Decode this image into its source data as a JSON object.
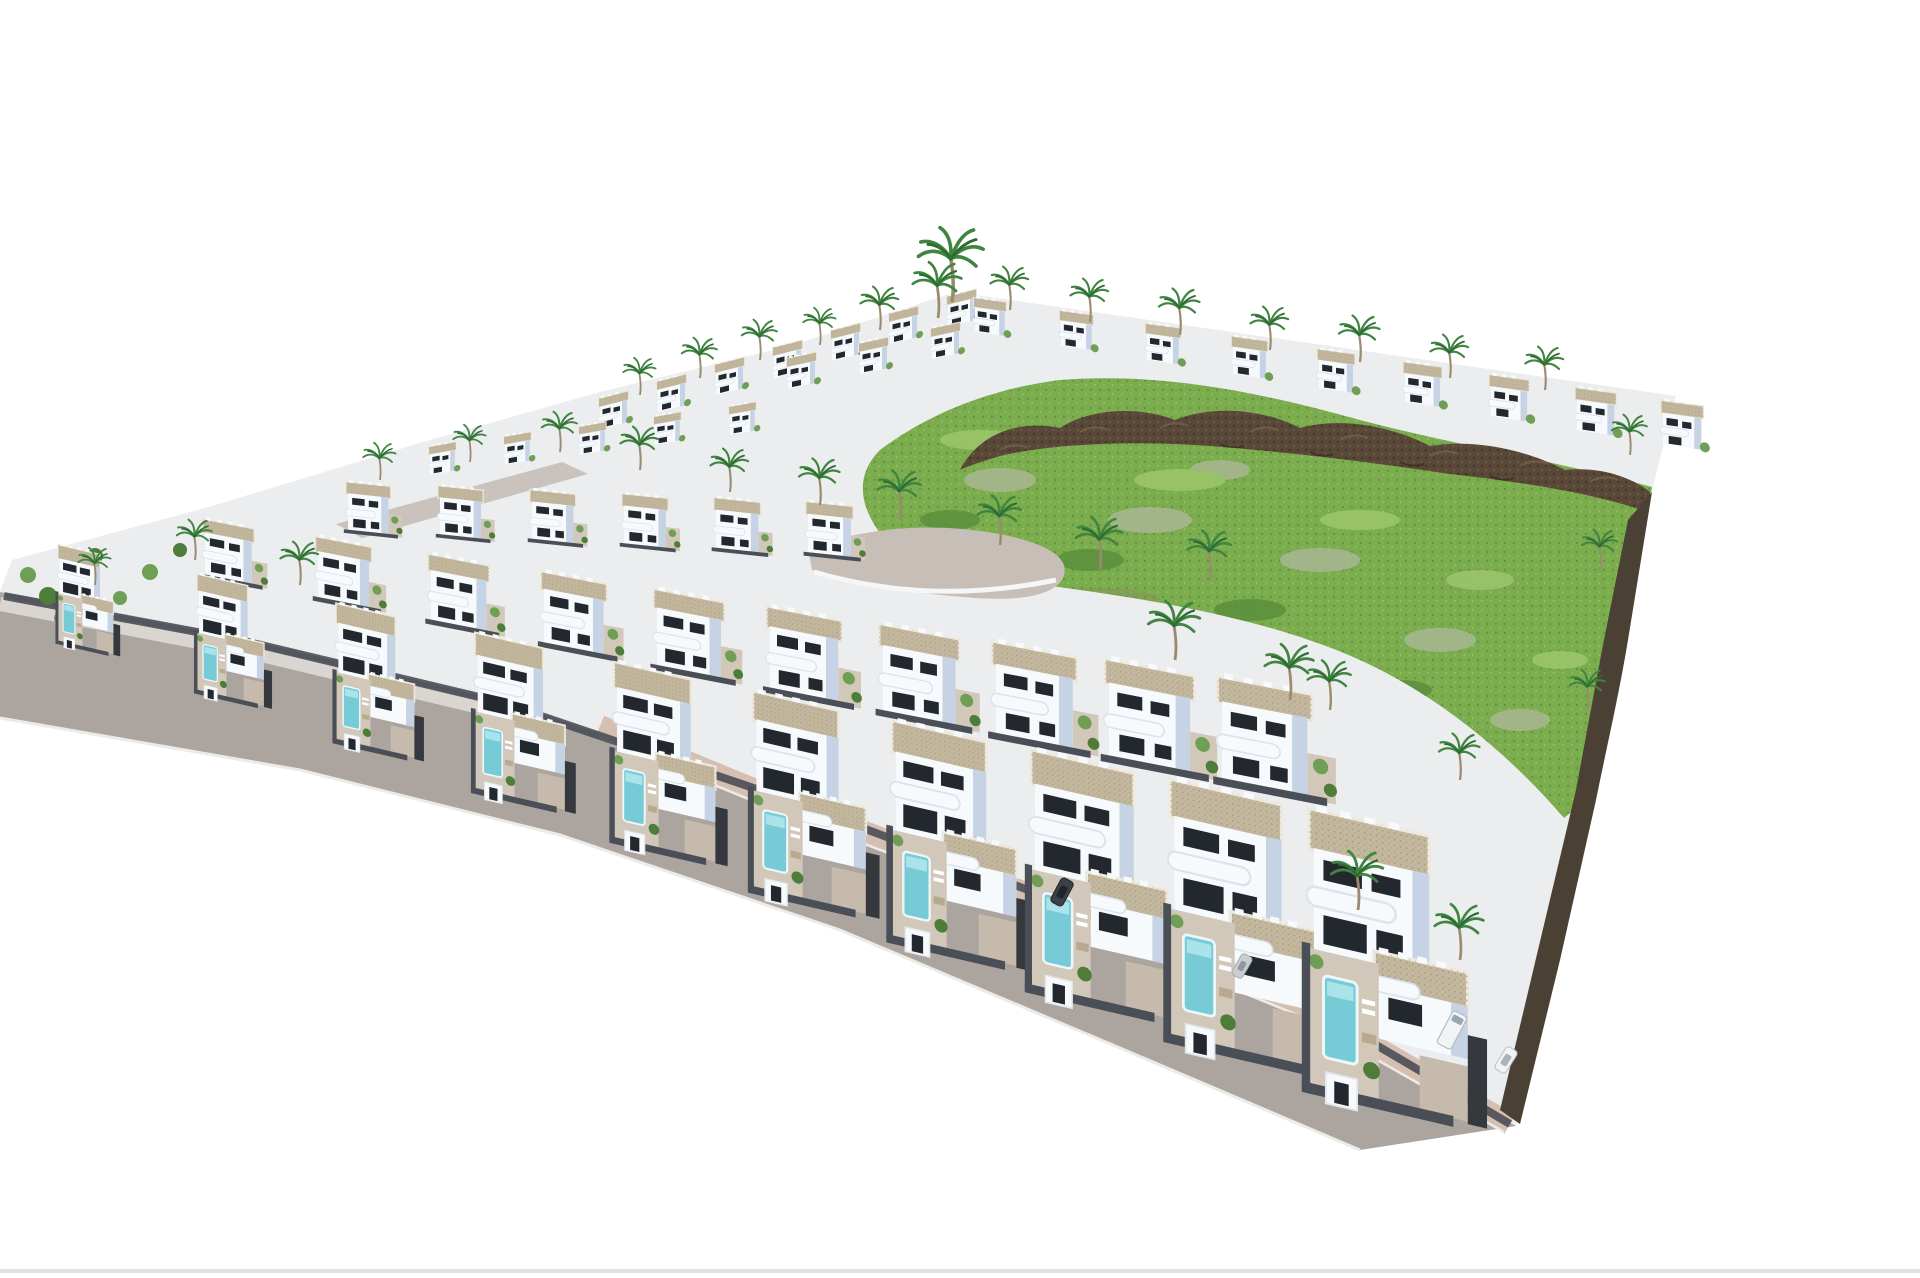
{
  "meta": {
    "description": "3D aerial rendering of a hillside residential development: rows of white modern villas with flat gravel roofs, curved balconies, private pools and palm trees; a green undeveloped hillside with dark volcanic rock outcrops in the centre-right; a grey perimeter road with pink sidewalk and parked cars along the lower-left edge; pure white background.",
    "background": "#ffffff"
  },
  "palette": {
    "villaWhite": "#f7fafd",
    "villaShade": "#c6d3e4",
    "villaShadeDeep": "#aabdd5",
    "roofBeige": "#c3b89e",
    "roofEdge": "#efeadf",
    "windowDark": "#23282e",
    "patio": "#d2c8ba",
    "drive": "#c5baab",
    "pool": "#76cbd7",
    "poolLight": "#aae3ea",
    "wallDark": "#4a4e56",
    "gravelDark": "#35393e",
    "ground": "#ecedef",
    "grass": "#7bac4e",
    "grassDark": "#5c8f3c",
    "grassLight": "#9dc66c",
    "sage": "#a9b795",
    "dirt": "#93805f",
    "rock": "#594738",
    "rockLight": "#7c6551",
    "rockDark": "#392c22",
    "road": "#aca49f",
    "roadLight": "#c6beb7",
    "sidewalkPink": "#d5bfb1",
    "sidewalkGray": "#d9d5d1",
    "curb": "#edebe8",
    "palmFrond": "#3f8540",
    "palmFrondDark": "#2f6b33",
    "palmTrunk": "#9b8a6e",
    "treeGreen": "#6f9e55",
    "treeGreenDark": "#4e7d3a",
    "carWhite": "#f1f3f5",
    "carDark": "#3d4147",
    "carSilver": "#c9ced3",
    "bottomLine": "#e0deda"
  },
  "scene": {
    "villa_rows": [
      {
        "name": "back-left-ridge-row",
        "count": 7,
        "x0": 600,
        "y0": 402,
        "dx": 58,
        "dy": -17,
        "s0": 0.5,
        "ds": 0,
        "skew": -14,
        "variant": "back"
      },
      {
        "name": "upper-mid-row",
        "count": 3,
        "x0": 788,
        "y0": 362,
        "dx": 72,
        "dy": -15,
        "s0": 0.5,
        "ds": 0,
        "skew": -12,
        "variant": "back"
      },
      {
        "name": "back-right-row",
        "count": 9,
        "x0": 975,
        "y0": 302,
        "dx": 86,
        "dy": 13,
        "s0": 0.55,
        "ds": 0.02,
        "skew": 8,
        "variant": "back"
      },
      {
        "name": "fourth-row",
        "count": 5,
        "x0": 430,
        "y0": 450,
        "dx": 75,
        "dy": -10,
        "s0": 0.46,
        "ds": 0,
        "skew": -10,
        "variant": "back"
      },
      {
        "name": "third-row",
        "count": 6,
        "x0": 348,
        "y0": 486,
        "dx": 92,
        "dy": 4,
        "s0": 0.52,
        "ds": 0.006,
        "skew": 6,
        "variant": "mid"
      },
      {
        "name": "second-row",
        "count": 10,
        "x0": 205,
        "y0": 524,
        "dx": 113,
        "dy": 18,
        "s0": 0.6,
        "ds": 0.055,
        "skew": 11,
        "variant": "mid"
      },
      {
        "name": "front-row",
        "count": 10,
        "x0": 58,
        "y0": 548,
        "dx": 139,
        "dy": 30,
        "s0": 0.42,
        "ds": 0.087,
        "skew": 13,
        "variant": "front"
      }
    ],
    "palms": [
      {
        "x": 952,
        "y": 302,
        "s": 1.2
      },
      {
        "x": 938,
        "y": 318,
        "s": 0.9
      },
      {
        "x": 640,
        "y": 395,
        "s": 0.6
      },
      {
        "x": 700,
        "y": 378,
        "s": 0.65
      },
      {
        "x": 760,
        "y": 360,
        "s": 0.65
      },
      {
        "x": 820,
        "y": 345,
        "s": 0.6
      },
      {
        "x": 880,
        "y": 330,
        "s": 0.7
      },
      {
        "x": 1010,
        "y": 310,
        "s": 0.7
      },
      {
        "x": 1090,
        "y": 322,
        "s": 0.7
      },
      {
        "x": 1180,
        "y": 335,
        "s": 0.75
      },
      {
        "x": 1270,
        "y": 350,
        "s": 0.7
      },
      {
        "x": 1360,
        "y": 362,
        "s": 0.75
      },
      {
        "x": 1450,
        "y": 378,
        "s": 0.7
      },
      {
        "x": 1545,
        "y": 390,
        "s": 0.7
      },
      {
        "x": 1630,
        "y": 455,
        "s": 0.65
      },
      {
        "x": 380,
        "y": 480,
        "s": 0.6
      },
      {
        "x": 470,
        "y": 462,
        "s": 0.6
      },
      {
        "x": 560,
        "y": 452,
        "s": 0.65
      },
      {
        "x": 640,
        "y": 470,
        "s": 0.7
      },
      {
        "x": 730,
        "y": 492,
        "s": 0.7
      },
      {
        "x": 820,
        "y": 505,
        "s": 0.75
      },
      {
        "x": 900,
        "y": 520,
        "s": 0.8
      },
      {
        "x": 1000,
        "y": 545,
        "s": 0.8
      },
      {
        "x": 1100,
        "y": 570,
        "s": 0.85
      },
      {
        "x": 95,
        "y": 585,
        "s": 0.6
      },
      {
        "x": 195,
        "y": 560,
        "s": 0.65
      },
      {
        "x": 300,
        "y": 585,
        "s": 0.7
      },
      {
        "x": 1175,
        "y": 660,
        "s": 0.95
      },
      {
        "x": 1290,
        "y": 700,
        "s": 0.9
      },
      {
        "x": 1210,
        "y": 580,
        "s": 0.8
      },
      {
        "x": 1330,
        "y": 710,
        "s": 0.8
      },
      {
        "x": 1460,
        "y": 780,
        "s": 0.75
      },
      {
        "x": 1600,
        "y": 570,
        "s": 0.65
      },
      {
        "x": 1588,
        "y": 710,
        "s": 0.65
      },
      {
        "x": 1358,
        "y": 910,
        "s": 0.95
      },
      {
        "x": 1460,
        "y": 960,
        "s": 0.9
      }
    ],
    "vehicles": [
      {
        "type": "car-dark",
        "x": 718,
        "y": 812,
        "s": 1.0,
        "r": -64
      },
      {
        "type": "suv-dark",
        "x": 1062,
        "y": 892,
        "s": 1.05,
        "r": -62
      },
      {
        "type": "car-silver",
        "x": 1242,
        "y": 966,
        "s": 1.0,
        "r": -60
      },
      {
        "type": "van-white",
        "x": 1452,
        "y": 1030,
        "s": 1.15,
        "r": -62
      },
      {
        "type": "car-white",
        "x": 1506,
        "y": 1060,
        "s": 1.0,
        "r": -58
      }
    ]
  }
}
